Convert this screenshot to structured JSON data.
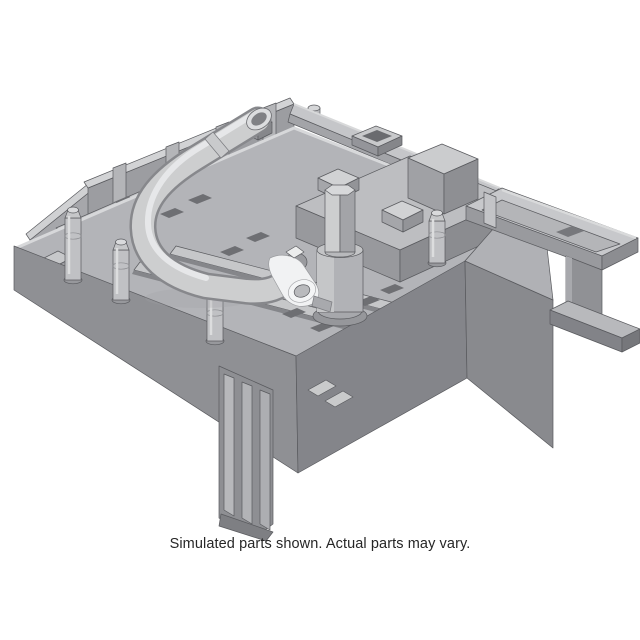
{
  "page": {
    "background": "#ffffff"
  },
  "figure": {
    "caption": "Simulated parts shown. Actual parts may vary.",
    "alt": "3D rendered gray plastic automotive fuse box lower tray bracket with a curved vent hose, hex stud, mounting posts, a side bracket arm and ribbed mounting legs",
    "caption_color": "#262626",
    "part_palette": {
      "top_light": "#d2d3d5",
      "surface_mid": "#b3b4b8",
      "wall_dark": "#8f9094",
      "outline": "#595a5e",
      "hose_highlight": "#e9eaeb",
      "fitting_white": "#f1f2f3"
    }
  }
}
